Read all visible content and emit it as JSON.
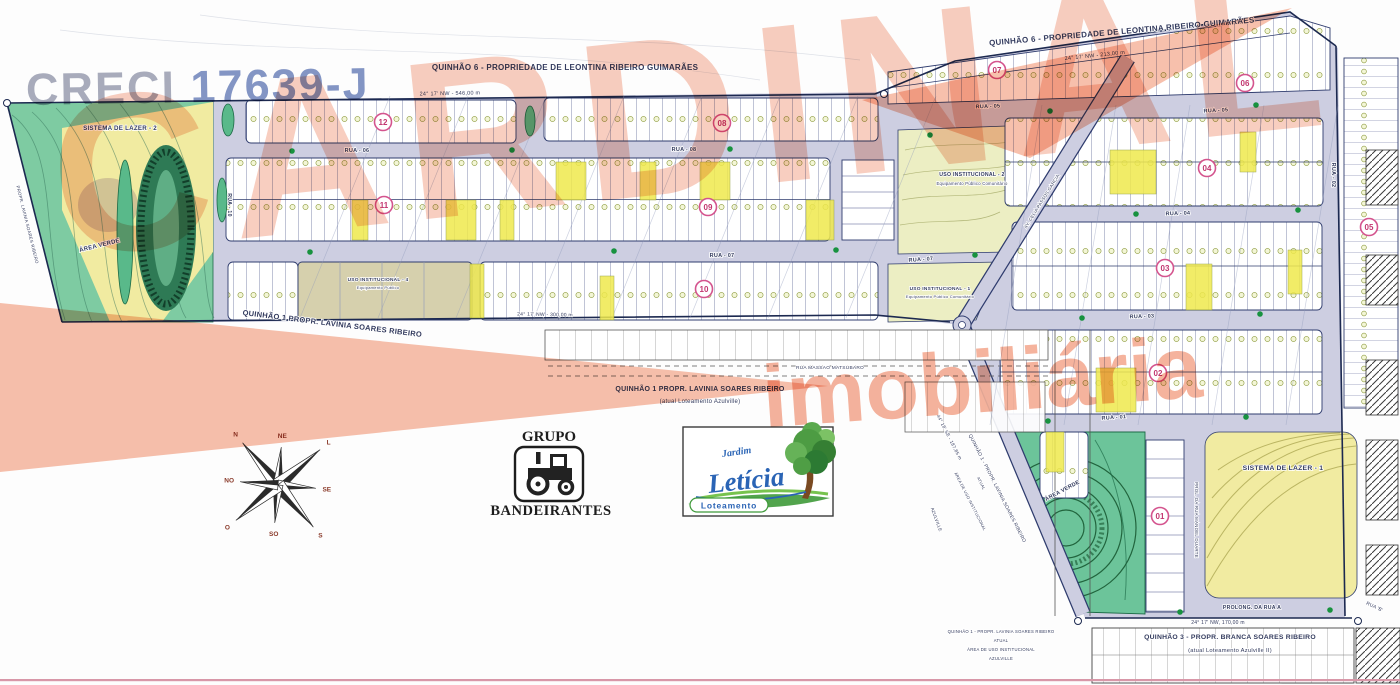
{
  "title": "Planta do Loteamento Jardim Letícia",
  "watermark": {
    "creci_label": "CRECI",
    "creci_number": "17639-J",
    "brand": "CARDINAL",
    "brand_sub": "imobiliária",
    "salmon": "#f2a183",
    "creci_gray": "#a9adbd",
    "creci_blue": "#8496c6"
  },
  "logos": {
    "grupo": {
      "line1": "GRUPO",
      "line2": "BANDEIRANTES"
    },
    "leticia": {
      "script": "Jardim",
      "name": "Letícia",
      "sub": "Loteamento"
    }
  },
  "palette": {
    "street_lavender": "#cdcee1",
    "lot_line_navy": "#2f3c6e",
    "area_yellow": "#f1eba1",
    "area_teal_green": "#7ecba2",
    "institutional_green": "#eceec3",
    "lot_yellow": "#efe94d",
    "quadra_ring_pink": "#d4548e",
    "quadra_text_pink": "#c2356f",
    "tree_green": "#18923f",
    "boundary_navy": "#1c2950"
  },
  "compass": {
    "points": [
      "N",
      "NE",
      "L",
      "SE",
      "S",
      "SO",
      "O",
      "NO"
    ]
  },
  "quadras": [
    {
      "n": "12",
      "x": 383,
      "y": 122
    },
    {
      "n": "08",
      "x": 722,
      "y": 123
    },
    {
      "n": "07",
      "x": 997,
      "y": 70
    },
    {
      "n": "06",
      "x": 1245,
      "y": 83
    },
    {
      "n": "11",
      "x": 384,
      "y": 205
    },
    {
      "n": "09",
      "x": 708,
      "y": 207
    },
    {
      "n": "10",
      "x": 704,
      "y": 289
    },
    {
      "n": "04",
      "x": 1207,
      "y": 168
    },
    {
      "n": "03",
      "x": 1165,
      "y": 268
    },
    {
      "n": "05",
      "x": 1369,
      "y": 227
    },
    {
      "n": "02",
      "x": 1158,
      "y": 373
    },
    {
      "n": "01",
      "x": 1160,
      "y": 516
    }
  ],
  "map_labels": [
    {
      "id": "quinhao6-top-left",
      "t": "QUINHÃO 6 - PROPRIEDADE DE LEONTINA RIBEIRO GUIMARÃES",
      "x": 565,
      "y": 70,
      "s": 8,
      "r": 0,
      "fw": 700
    },
    {
      "id": "quinhao6-top-right",
      "t": "QUINHÃO 6 - PROPRIEDADE DE LEONTINA RIBEIRO GUIMARÃES",
      "x": 1122,
      "y": 34,
      "s": 8,
      "r": -5,
      "fw": 700
    },
    {
      "id": "dim-top-left",
      "t": "24° 17' NW - 546,00 m",
      "x": 450,
      "y": 95,
      "s": 5.5,
      "r": -1,
      "fw": 400
    },
    {
      "id": "dim-top-right",
      "t": "24° 17' NW - 213,00 m",
      "x": 1095,
      "y": 57,
      "s": 5.5,
      "r": -6,
      "fw": 400
    },
    {
      "id": "dim-left-bottom",
      "t": "24° 17' NW - 300,00 m",
      "x": 545,
      "y": 316,
      "s": 5,
      "r": 1,
      "fw": 400
    },
    {
      "id": "dim-bottom",
      "t": "24° 17' NW, 170,00 m",
      "x": 1218,
      "y": 624,
      "s": 5,
      "r": 0,
      "fw": 400
    },
    {
      "id": "dim-avenue",
      "t": "44° 18' SE - 187,85 m",
      "x": 948,
      "y": 438,
      "s": 4.6,
      "r": 63,
      "fw": 400
    },
    {
      "id": "quinhao1-diagonal",
      "t": "QUINHÃO 1 PROPR. LAVINIA SOARES RIBEIRO",
      "x": 332,
      "y": 326,
      "s": 7.5,
      "r": 7,
      "fw": 700
    },
    {
      "id": "quinhao1-center",
      "t": "QUINHÃO 1 PROPR. LAVINIA SOARES RIBEIRO",
      "x": 700,
      "y": 391,
      "s": 7,
      "r": 0,
      "fw": 700
    },
    {
      "id": "quinhao1-center-sub",
      "t": "(atual Loteamento Azulville)",
      "x": 700,
      "y": 403,
      "s": 6,
      "r": 0,
      "fw": 400
    },
    {
      "id": "sistema-lazer-2",
      "t": "SISTEMA DE LAZER - 2",
      "x": 120,
      "y": 130,
      "s": 6.2,
      "r": 0,
      "fw": 700
    },
    {
      "id": "area-verde-left",
      "t": "ÁREA VERDE",
      "x": 100,
      "y": 247,
      "s": 6,
      "r": -14,
      "fw": 700,
      "c": "#1d5c3a"
    },
    {
      "id": "sistema-lazer-1",
      "t": "SISTEMA DE LAZER - 1",
      "x": 1283,
      "y": 470,
      "s": 6.8,
      "r": 0,
      "fw": 700
    },
    {
      "id": "area-verde-right",
      "t": "ÁREA VERDE",
      "x": 1063,
      "y": 492,
      "s": 5.5,
      "r": -28,
      "fw": 700,
      "c": "#1d5c3a",
      "ls": 3
    },
    {
      "id": "uso-institucional-2",
      "t": "USO INSTITUCIONAL - 2",
      "x": 972,
      "y": 176,
      "s": 5.2,
      "r": 0,
      "fw": 700
    },
    {
      "id": "uso-institucional-2-sub",
      "t": "Equipamento Público Comunitário",
      "x": 972,
      "y": 185,
      "s": 4.2,
      "r": 0,
      "fw": 400
    },
    {
      "id": "uso-institucional-1",
      "t": "USO INSTITUCIONAL - 1",
      "x": 940,
      "y": 290,
      "s": 4.8,
      "r": 0,
      "fw": 700
    },
    {
      "id": "uso-institucional-1-sub",
      "t": "Equipamento Público Comunitário",
      "x": 940,
      "y": 298,
      "s": 4,
      "r": 0,
      "fw": 400
    },
    {
      "id": "uso-institucional-4",
      "t": "USO INSTITUCIONAL - 4",
      "x": 378,
      "y": 281,
      "s": 4.8,
      "r": 0,
      "fw": 700
    },
    {
      "id": "uso-institucional-4-sub",
      "t": "Equipamento Público",
      "x": 378,
      "y": 289,
      "s": 4,
      "r": 0,
      "fw": 400
    },
    {
      "id": "rua-06",
      "t": "RUA - 06",
      "x": 357,
      "y": 152,
      "s": 5.5,
      "r": 0,
      "fw": 700
    },
    {
      "id": "rua-08",
      "t": "RUA - 08",
      "x": 684,
      "y": 151,
      "s": 5.5,
      "r": 0,
      "fw": 700
    },
    {
      "id": "rua-07-a",
      "t": "RUA - 07",
      "x": 722,
      "y": 257,
      "s": 5.5,
      "r": 0,
      "fw": 700
    },
    {
      "id": "rua-07-b",
      "t": "RUA - 07",
      "x": 921,
      "y": 261,
      "s": 5.5,
      "r": -4,
      "fw": 700
    },
    {
      "id": "rua-05-a",
      "t": "RUA - 05",
      "x": 988,
      "y": 108,
      "s": 5.5,
      "r": -2,
      "fw": 700
    },
    {
      "id": "rua-05-b",
      "t": "RUA - 05",
      "x": 1216,
      "y": 112,
      "s": 5.5,
      "r": -3,
      "fw": 700
    },
    {
      "id": "rua-04",
      "t": "RUA - 04",
      "x": 1178,
      "y": 215,
      "s": 5.5,
      "r": -2,
      "fw": 700
    },
    {
      "id": "rua-03",
      "t": "RUA - 03",
      "x": 1142,
      "y": 318,
      "s": 5.5,
      "r": -2,
      "fw": 700
    },
    {
      "id": "rua-01",
      "t": "RUA - 01",
      "x": 1114,
      "y": 419,
      "s": 5.5,
      "r": -4,
      "fw": 700
    },
    {
      "id": "rua-02-v",
      "t": "RUA - 02",
      "x": 1332,
      "y": 175,
      "s": 5.5,
      "r": 90,
      "fw": 700
    },
    {
      "id": "rua-10-v",
      "t": "RUA - 10",
      "x": 228,
      "y": 205,
      "s": 5.2,
      "r": 90,
      "fw": 700
    },
    {
      "id": "rua-massao-matsubaro",
      "t": "RUA MASSAO MATSUBARO",
      "x": 830,
      "y": 369,
      "s": 4.8,
      "r": 0,
      "fw": 400
    },
    {
      "id": "prol-rua-manoel-duarte",
      "t": "PROL. DA RUA MANOEL DUARTE",
      "x": 1195,
      "y": 520,
      "s": 4.4,
      "r": 90,
      "fw": 400
    },
    {
      "id": "prolong-da-rua-a",
      "t": "PROLONG. DA RUA A",
      "x": 1252,
      "y": 609,
      "s": 5.2,
      "r": 0,
      "fw": 700
    },
    {
      "id": "rua-b",
      "t": "RUA 'B'",
      "x": 1374,
      "y": 608,
      "s": 4.8,
      "r": 25,
      "fw": 400
    },
    {
      "id": "av-celia-passos-garcia",
      "t": "AV. CELIA PASSOS GARCIA",
      "x": 1043,
      "y": 202,
      "s": 4.4,
      "r": -58,
      "fw": 400
    },
    {
      "id": "quinhao3-bottom",
      "t": "QUINHÃO 3 - PROPR. BRANCA SOARES RIBEIRO",
      "x": 1230,
      "y": 639,
      "s": 6.8,
      "r": 0,
      "fw": 700
    },
    {
      "id": "quinhao3-bottom-sub",
      "t": "(atual Loteamento Azulville II)",
      "x": 1230,
      "y": 652,
      "s": 5.8,
      "r": 0,
      "fw": 400
    },
    {
      "id": "q1-atual-1",
      "t": "QUINHÃO 1 - PROPR. LAVINIA SOARES RIBEIRO",
      "x": 1001,
      "y": 633,
      "s": 4.2,
      "r": 0,
      "fw": 400
    },
    {
      "id": "q1-atual-2",
      "t": "ATUAL",
      "x": 1001,
      "y": 642,
      "s": 4.2,
      "r": 0,
      "fw": 400
    },
    {
      "id": "q1-atual-3",
      "t": "ÁREA DE USO INSTITUCIONAL",
      "x": 1001,
      "y": 651,
      "s": 4.2,
      "r": 0,
      "fw": 400
    },
    {
      "id": "q1-atual-4",
      "t": "AZULVILLE",
      "x": 1001,
      "y": 660,
      "s": 4.2,
      "r": 0,
      "fw": 400
    },
    {
      "id": "diag-quinhao1",
      "t": "QUINHÃO 1 - PROPR. LAVINIA SOARES RIBEIRO",
      "x": 996,
      "y": 489,
      "s": 4.8,
      "r": 63,
      "fw": 400
    },
    {
      "id": "diag-atual",
      "t": "ATUAL",
      "x": 980,
      "y": 484,
      "s": 4,
      "r": 63,
      "fw": 400
    },
    {
      "id": "diag-area-uso",
      "t": "ÁREA DE USO INSTITUCIONAL",
      "x": 969,
      "y": 502,
      "s": 4,
      "r": 63,
      "fw": 400
    },
    {
      "id": "azulville-v",
      "t": "AZULVILLE",
      "x": 935,
      "y": 520,
      "s": 4.4,
      "r": 70,
      "fw": 400
    },
    {
      "id": "left-edge-propr",
      "t": "PROPR. LAVINIA SOARES RIBEIRO",
      "x": 26,
      "y": 225,
      "s": 4.4,
      "r": 76,
      "fw": 400
    }
  ]
}
